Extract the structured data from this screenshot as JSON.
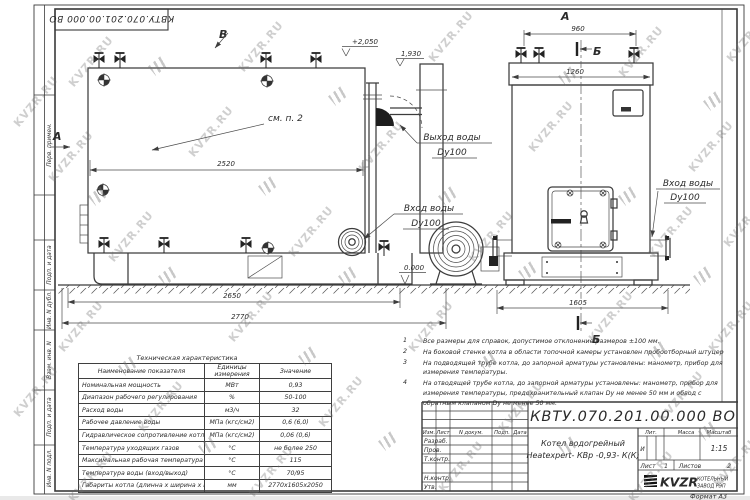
{
  "watermark": {
    "text": "KVZR.RU"
  },
  "stamp": {
    "doc_number_rotated": "КВТУ.070.201.00.000  ВО"
  },
  "margin": {
    "labels": [
      "Перв. примен.",
      "Подп. и дата",
      "Инв. N дубл.",
      "Взам. инв. N",
      "Подп. и дата",
      "Инв. N подл."
    ]
  },
  "drawing": {
    "view_a_left": "А",
    "view_a_top": "А",
    "view_b_top": "Б",
    "view_b_bottom": "Б",
    "view_v": "В",
    "see_note": "см. п. 2",
    "level_top": "+2,050",
    "level_mid": "1,930",
    "level_zero": "0.000",
    "dim_2520": "2520",
    "dim_2650": "2650",
    "dim_2770": "2770",
    "dim_960": "960",
    "dim_1260": "1260",
    "dim_1605": "1605",
    "outlet_label": "Выход воды",
    "outlet_dn": "Dy100",
    "inlet_label": "Вход воды",
    "inlet_dn": "Dy100",
    "inlet2_label": "Вход воды",
    "inlet2_dn": "Dy100"
  },
  "tech_table": {
    "title": "Техническая характеристика",
    "headers": [
      "Наименование показателя",
      "Единицы измерения",
      "Значение"
    ],
    "rows": [
      {
        "name": "Номинальная мощность",
        "unit": "МВт",
        "value": "0,93"
      },
      {
        "name": "Диапазон рабочего регулирования",
        "unit": "%",
        "value": "50-100"
      },
      {
        "name": "Расход воды",
        "unit": "м3/ч",
        "value": "32"
      },
      {
        "name": "Рабочее давление воды",
        "unit": "МПа (кгс/см2)",
        "value": "0,6 (6,0)"
      },
      {
        "name": "Гидравлическое сопротивление котла",
        "unit": "МПа (кгс/см2)",
        "value": "0,06 (0,6)"
      },
      {
        "name": "Температура уходящих газов",
        "unit": "°С",
        "value": "не более 250"
      },
      {
        "name": "Максимальная рабочая температура воды",
        "unit": "°С",
        "value": "115"
      },
      {
        "name": "Температура воды (вход/выход)",
        "unit": "°С",
        "value": "70/95"
      },
      {
        "name": "Габариты котла (длинна х ширина х высота)",
        "unit": "мм",
        "value": "2770х1605х2050"
      }
    ]
  },
  "notes": [
    {
      "num": "1",
      "text": "Все размеры для справок, допустимое отклонение размеров ±100 мм."
    },
    {
      "num": "2",
      "text": "На боковой стенке котла в области топочной камеры установлен пробоотборный штуцер"
    },
    {
      "num": "3",
      "text": "На  подводящей трубе котла, до запорной арматуры установлены: манометр, прибор для измерения температуры."
    },
    {
      "num": "4",
      "text": "На отводящей трубе котла, до запорной арматуры установлены: манометр, прибор для измерения температуры, предохранительный клапан  Dу не менее  50 мм и обвод с обратным клапаном  Dу не менее  50 мм."
    }
  ],
  "title_block": {
    "doc_number": "КВТУ.070.201.00.000  ВО",
    "rev_headers": [
      "Изм.",
      "Лист",
      "N докум.",
      "Подп.",
      "Дата"
    ],
    "roles": [
      "Разраб.",
      "Пров.",
      "Т.контр.",
      "Н.контр.",
      "Утв."
    ],
    "product_line1": "Котел водогрейный",
    "product_line2": "Heatexpert- КВр -0,93- К(К)",
    "lit_label": "Лит.",
    "mass_label": "Масса",
    "scale_label": "Масштаб",
    "lit_value": "И",
    "scale_value": "1:15",
    "sheet_label": "Лист",
    "sheet_value": "1",
    "sheets_label": "Листов",
    "sheets_value": "2",
    "company_name": "KVZR",
    "company_sub1": "КОТЕЛЬНЫЙ",
    "company_sub2": "ЗАВОД РЭП",
    "format_note": "Формат  А3"
  }
}
